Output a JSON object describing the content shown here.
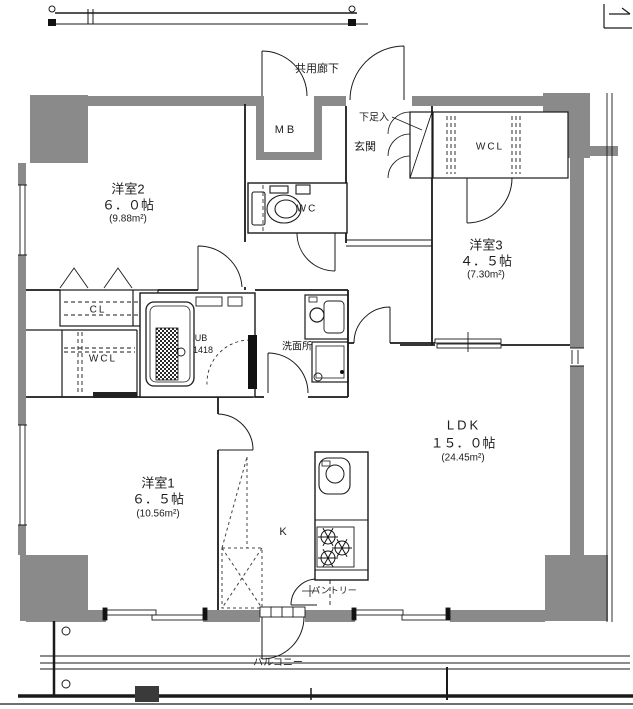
{
  "floorplan": {
    "wall_color": "#8a8a8a",
    "line_color": "#1a1a1a",
    "rooms": [
      {
        "id": "yoshitsu2",
        "name": "洋室2",
        "size": "６．０帖",
        "area": "(9.88m²)"
      },
      {
        "id": "yoshitsu3",
        "name": "洋室3",
        "size": "４．５帖",
        "area": "(7.30m²)"
      },
      {
        "id": "yoshitsu1",
        "name": "洋室1",
        "size": "６．５帖",
        "area": "(10.56m²)"
      },
      {
        "id": "ldk",
        "name": "LDK",
        "size": "１５．０帖",
        "area": "(24.45m²)"
      }
    ],
    "labels": {
      "corridor": "共用廊下",
      "mb": "MB",
      "shoe": "下足入",
      "genkan": "玄関",
      "wc": "WC",
      "wcl_upper": "WCL",
      "cl": "CL",
      "wcl_lower": "WCL",
      "ub": "UB",
      "ub_num": "1418",
      "washroom": "洗面所",
      "kitchen": "K",
      "pantry": "パントリー",
      "balcony": "バルコニー"
    }
  }
}
